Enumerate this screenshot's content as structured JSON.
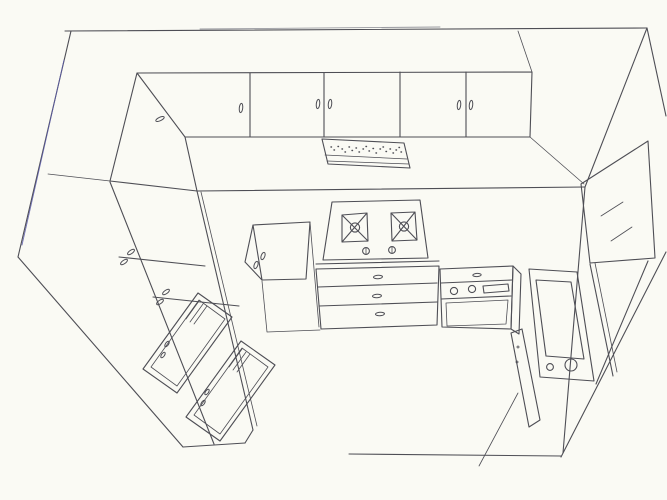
{
  "colors": {
    "paper": "#fafaf4",
    "ink": "#4e4e55",
    "ink_light": "#999aa0",
    "ink_blue": "#5a5aa8"
  },
  "scene": {
    "description": "Hand-drawn axonometric ink line drawing of a U-shaped kitchen on off-white paper, no text labels",
    "components": [
      {
        "id": "room-shell",
        "label": "Room shell: ceiling line, wall corner diagonals, wall base and floor construction lines"
      },
      {
        "id": "upper-cabinets",
        "label": "Back-wall upper cabinet run with five doors and six small oval handles"
      },
      {
        "id": "return-cabinet",
        "label": "Angled corner upper cabinet with one oval handle"
      },
      {
        "id": "range-hood",
        "label": "Extractor hood with stippled vent grille strip"
      },
      {
        "id": "cooktop",
        "label": "Two-burner cooktop with X-shaped grates, center rings and two control knobs"
      },
      {
        "id": "corner-cabinet",
        "label": "Small corner base cabinet with two oval handles"
      },
      {
        "id": "drawer-unit",
        "label": "Three-drawer base unit with oval drawer pulls"
      },
      {
        "id": "oven-unit",
        "label": "Base appliance with top drawer, two round knobs, display slot and lower door"
      },
      {
        "id": "appliance-door-panel",
        "label": "Tilted appliance front panel with rectangular window and two round controls"
      },
      {
        "id": "right-wall-unit",
        "label": "Tall right-wall unit drawn as a parallelogram with division dashes"
      },
      {
        "id": "left-wall-cabinets",
        "label": "Left-wall cabinet band with two door divisions and two pairs of oval handles"
      },
      {
        "id": "left-appliance-fronts",
        "label": "Two framed appliance fronts with vent slots and small oval knobs"
      },
      {
        "id": "floor-lines",
        "label": "Floor edge and skirting lines at bottom of drawing"
      }
    ],
    "counts": {
      "upper_doors": 5,
      "upper_handles": 6,
      "burners": 2,
      "cooktop_knobs": 2,
      "drawers": 3,
      "oven_knobs": 2,
      "framed_fronts": 2
    }
  }
}
